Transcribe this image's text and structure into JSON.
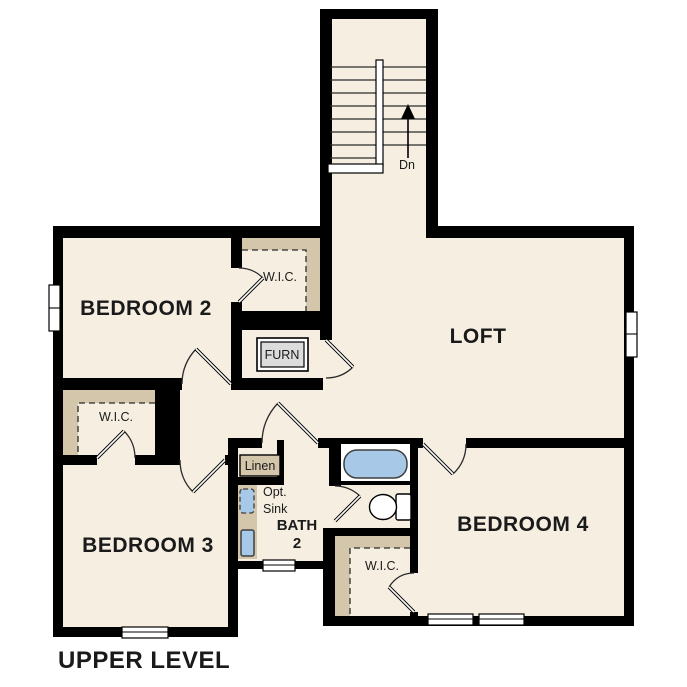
{
  "title": "UPPER LEVEL",
  "rooms": {
    "bedroom2": "BEDROOM 2",
    "bedroom3": "BEDROOM 3",
    "bedroom4": "BEDROOM 4",
    "loft": "LOFT",
    "bath_line1": "BATH",
    "bath_line2": "2"
  },
  "closets": {
    "wic": "W.I.C.",
    "linen": "Linen"
  },
  "fixtures": {
    "furnace": "FURN",
    "opt_sink_line1": "Opt.",
    "opt_sink_line2": "Sink"
  },
  "stairs": {
    "direction": "Dn"
  },
  "colors": {
    "wall": "#000000",
    "floor": "#f6efe1",
    "shelving": "#d4c6aa",
    "fixture_blue": "#a8c8e8",
    "furnace_gray": "#dcdcdc",
    "background": "#ffffff",
    "text": "#1a1a1a"
  }
}
